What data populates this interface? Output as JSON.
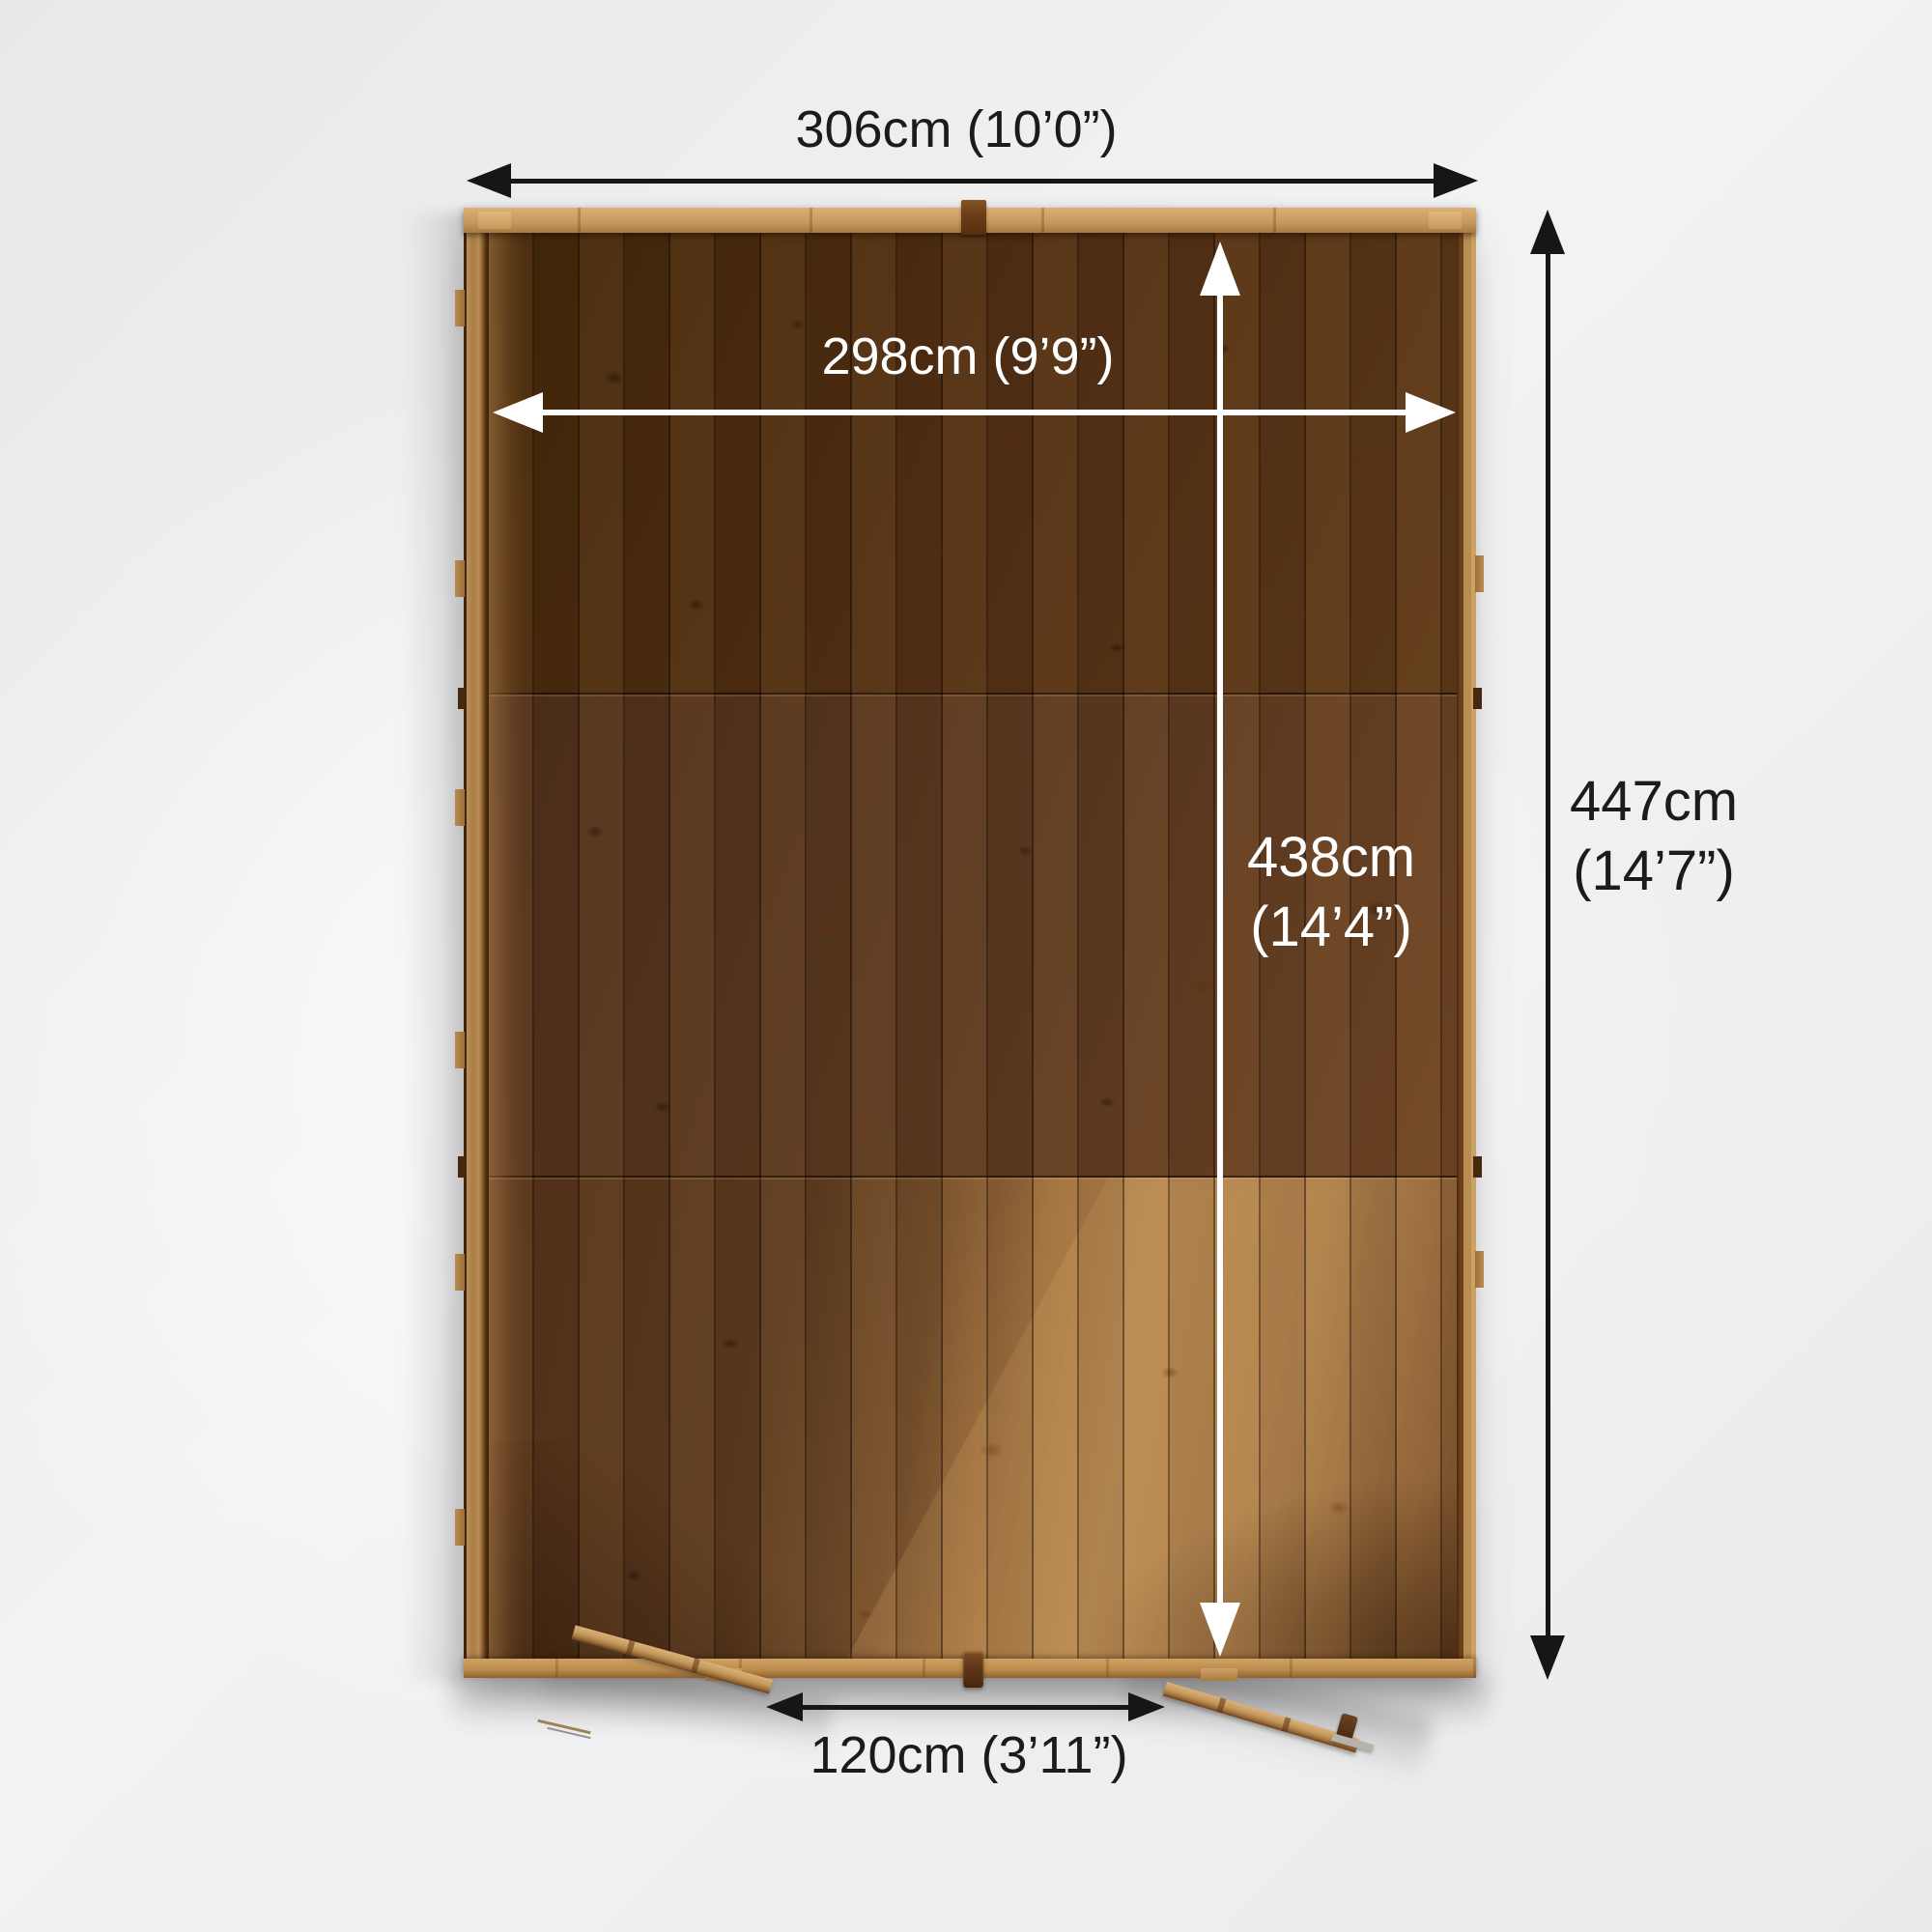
{
  "diagram": {
    "type": "shed-floor-plan-top-view",
    "labels": {
      "outer_width": "306cm (10’0”)",
      "inner_width": "298cm (9’9”)",
      "inner_depth_line1": "438cm",
      "inner_depth_line2": "(14’4”)",
      "outer_depth_line1": "447cm",
      "outer_depth_line2": "(14’7”)",
      "door_width": "120cm (3’11”)"
    },
    "colors": {
      "background": "#f0f0f1",
      "wood_frame": "#c59a5f",
      "wood_dark_interior": "#53331b",
      "wood_lit_interior": "#b2854f",
      "arrow_outer": "#161616",
      "arrow_inner": "#ffffff",
      "label_dark": "#1b1b1b",
      "label_light": "#ffffff"
    }
  }
}
